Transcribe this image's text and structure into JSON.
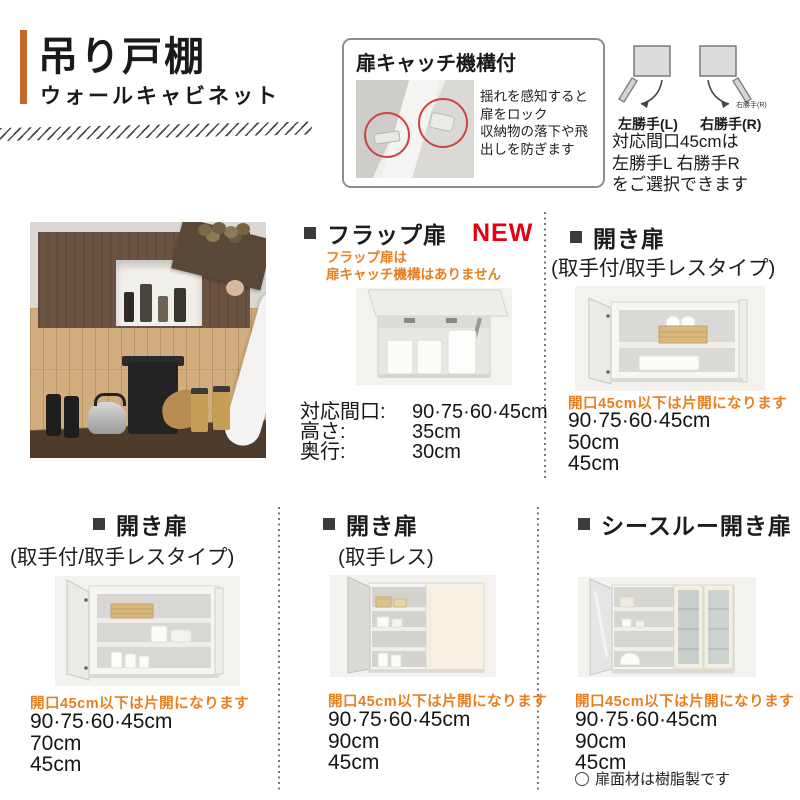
{
  "header": {
    "title": "吊り戸棚",
    "subtitle": "ウォールキャビネット"
  },
  "feature_box": {
    "title": "扉キャッチ機構付",
    "desc_lines": [
      "揺れを感知すると",
      "扉をロック",
      "収納物の落下や飛",
      "出しを防ぎます"
    ]
  },
  "handing": {
    "left_label": "左勝手(L)",
    "right_label": "右勝手(R)",
    "right_tiny_label": "右勝手(R)",
    "note_lines": [
      "対応間口45cmは",
      "左勝手L 右勝手R",
      "をご選択できます"
    ]
  },
  "sections": {
    "flap": {
      "title": "フラップ扉",
      "badge": "NEW",
      "note_lines": [
        "フラップ扉は",
        "扉キャッチ機構はありません"
      ],
      "specs": [
        {
          "label": "対応間口:",
          "value": "90·75·60·45cm"
        },
        {
          "label": "高さ:",
          "value": "35cm"
        },
        {
          "label": "奥行:",
          "value": "30cm"
        }
      ]
    },
    "hinged_top": {
      "title": "開き扉",
      "subtitle": "(取手付/取手レスタイプ)",
      "note": "開口45cm以下は片開になります",
      "sizes": [
        "90·75·60·45cm",
        "50cm",
        "45cm"
      ]
    },
    "hinged_left": {
      "title": "開き扉",
      "subtitle": "(取手付/取手レスタイプ)",
      "note": "開口45cm以下は片開になります",
      "sizes": [
        "90·75·60·45cm",
        "70cm",
        "45cm"
      ]
    },
    "hinged_handleless": {
      "title": "開き扉",
      "subtitle": "(取手レス)",
      "note": "開口45cm以下は片開になります",
      "sizes": [
        "90·75·60·45cm",
        "90cm",
        "45cm"
      ]
    },
    "see_through": {
      "title": "シースルー開き扉",
      "note": "開口45cm以下は片開になります",
      "sizes": [
        "90·75·60·45cm",
        "90cm",
        "45cm"
      ],
      "footnote": "扉面材は樹脂製です"
    }
  },
  "colors": {
    "accent_orange": "#c4682e",
    "note_orange": "#e87f1f",
    "new_red": "#e60012"
  }
}
